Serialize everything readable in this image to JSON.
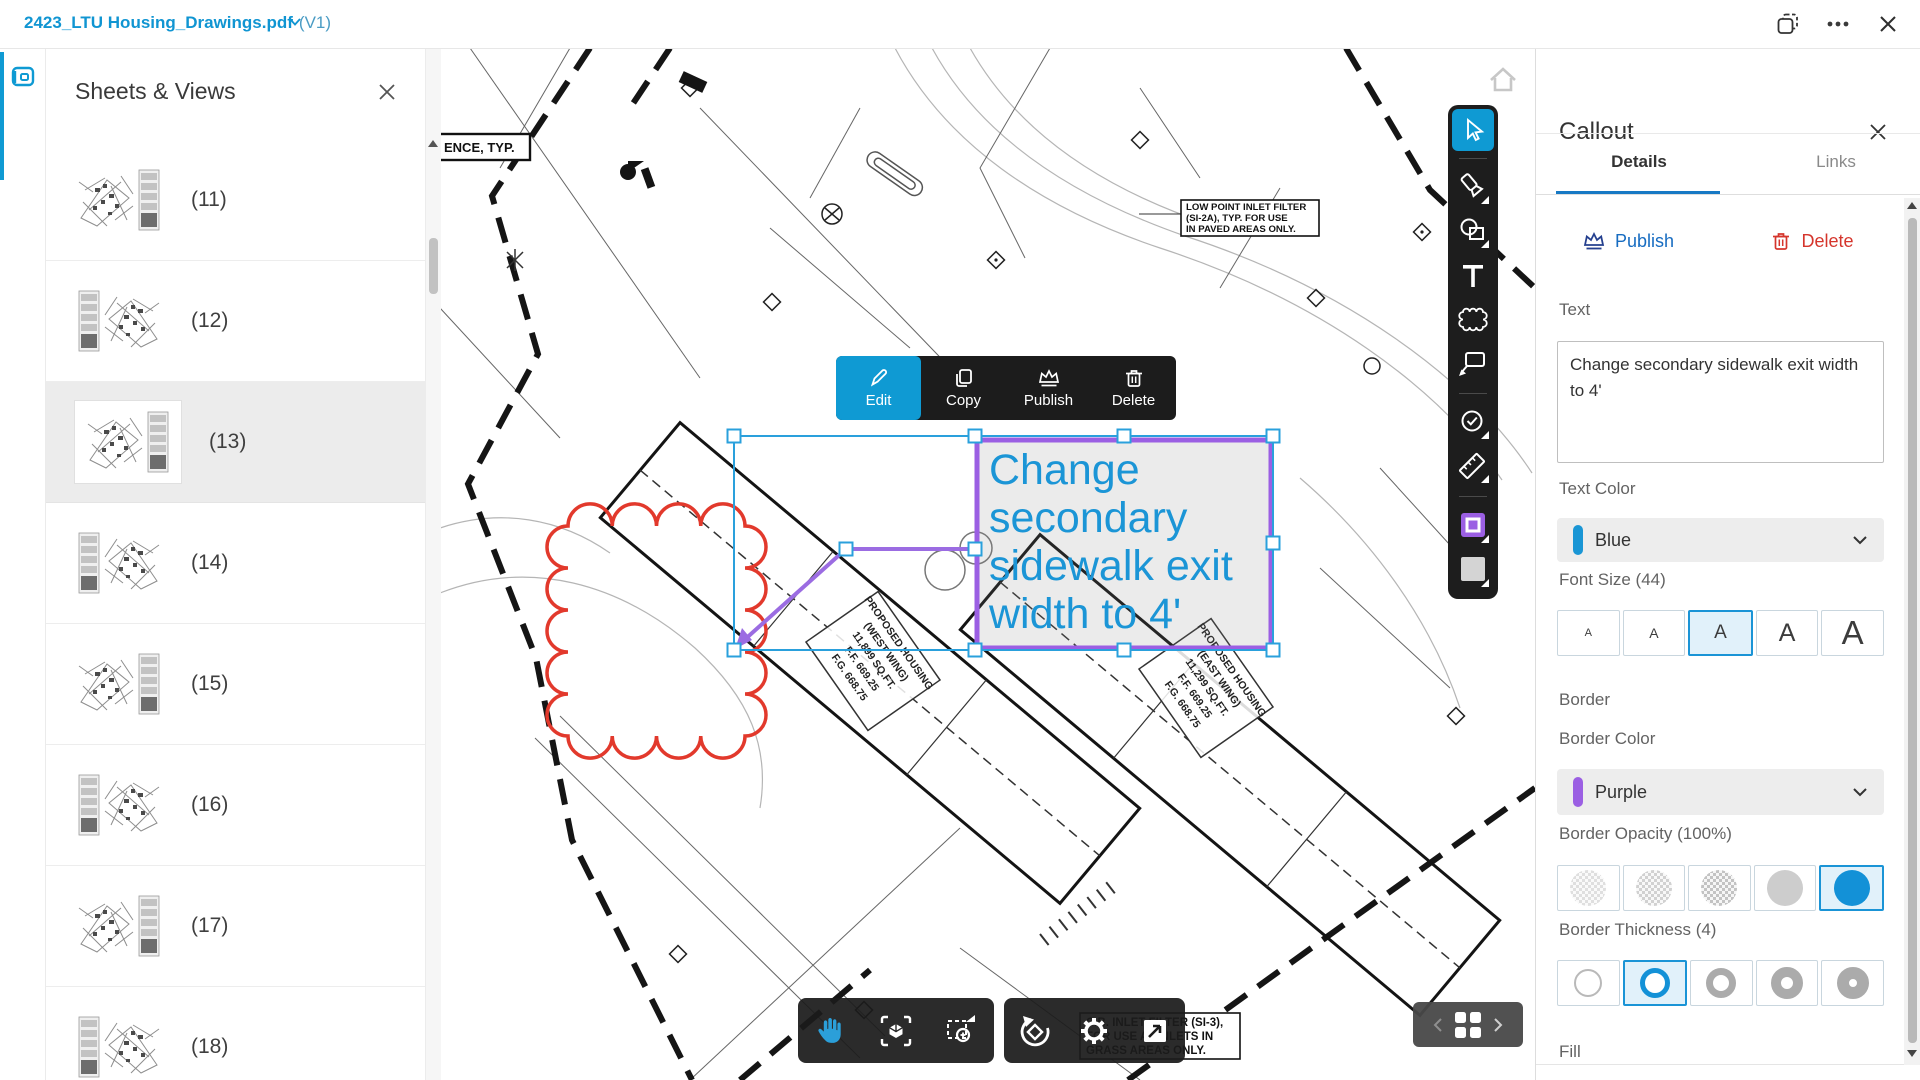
{
  "titlebar": {
    "document_title": "2423_LTU Housing_Drawings.pdf",
    "version": "(V1)"
  },
  "sheets_panel": {
    "title": "Sheets & Views",
    "items": [
      {
        "label": "(11)"
      },
      {
        "label": "(12)"
      },
      {
        "label": "(13)",
        "selected": true
      },
      {
        "label": "(14)"
      },
      {
        "label": "(15)"
      },
      {
        "label": "(16)"
      },
      {
        "label": "(17)"
      },
      {
        "label": "(18)"
      }
    ]
  },
  "context_toolbar": {
    "edit": "Edit",
    "copy": "Copy",
    "publish": "Publish",
    "delete": "Delete"
  },
  "annotation": {
    "callout_text": "Change secondary sidewalk exit width to 4'",
    "text_color_hex": "#1b95d6",
    "border_color_hex": "#9b5fe3",
    "selection_color_hex": "#2aa0dc",
    "revision_cloud_color_hex": "#e2392c"
  },
  "annotation_toolbar": {
    "tools": [
      "select",
      "draw",
      "shapes",
      "text",
      "cloud",
      "callout",
      "status",
      "measure"
    ],
    "swatches": [
      "border-color",
      "fill-color"
    ]
  },
  "viewer_toolbar": {
    "left": [
      "pan",
      "fit-view",
      "zoom-window"
    ],
    "right": [
      "reset-orientation",
      "settings",
      "fullscreen"
    ]
  },
  "page_navigator": {
    "icons": [
      "prev",
      "grid",
      "next"
    ]
  },
  "drawing_labels": {
    "fence_note": "ENCE, TYP.",
    "low_point_box": [
      "LOW POINT INLET FILTER",
      "(SI-2A), TYP. FOR USE",
      "IN PAVED AREAS ONLY."
    ],
    "west_wing": [
      "PROPOSED HOUSING",
      "(WEST WING)",
      "11,899 SQ.FT.",
      "F.F. 669.25",
      "F.G. 668.75"
    ],
    "east_wing": [
      "PROPOSED HOUSING",
      "(EAST WING)",
      "11,299 SQ.FT.",
      "F.F. 669.25",
      "F.G. 668.75"
    ],
    "cb_inlet_box": [
      "C.B. INLET FILTER (SI-3),",
      "FOR USE AT INLETS IN",
      "GRASS AREAS ONLY."
    ]
  },
  "callout_panel": {
    "title": "Callout",
    "tabs": [
      {
        "label": "Details",
        "active": true
      },
      {
        "label": "Links",
        "active": false
      }
    ],
    "publish_label": "Publish",
    "delete_label": "Delete",
    "text_field": {
      "label": "Text",
      "value": "Change secondary sidewalk exit width to 4'"
    },
    "text_color": {
      "label": "Text Color",
      "value": "Blue",
      "swatch_hex": "#1a96d5"
    },
    "font_size": {
      "label": "Font Size (44)",
      "options": [
        "A",
        "A",
        "A",
        "A",
        "A"
      ],
      "selected_index": 2
    },
    "border_section": {
      "label": "Border"
    },
    "border_color": {
      "label": "Border Color",
      "value": "Purple",
      "swatch_hex": "#9b5fe3"
    },
    "border_opacity": {
      "label": "Border Opacity (100%)",
      "selected_index": 4
    },
    "border_thickness": {
      "label": "Border Thickness (4)",
      "selected_index": 1
    },
    "fill_section": {
      "label": "Fill"
    }
  }
}
